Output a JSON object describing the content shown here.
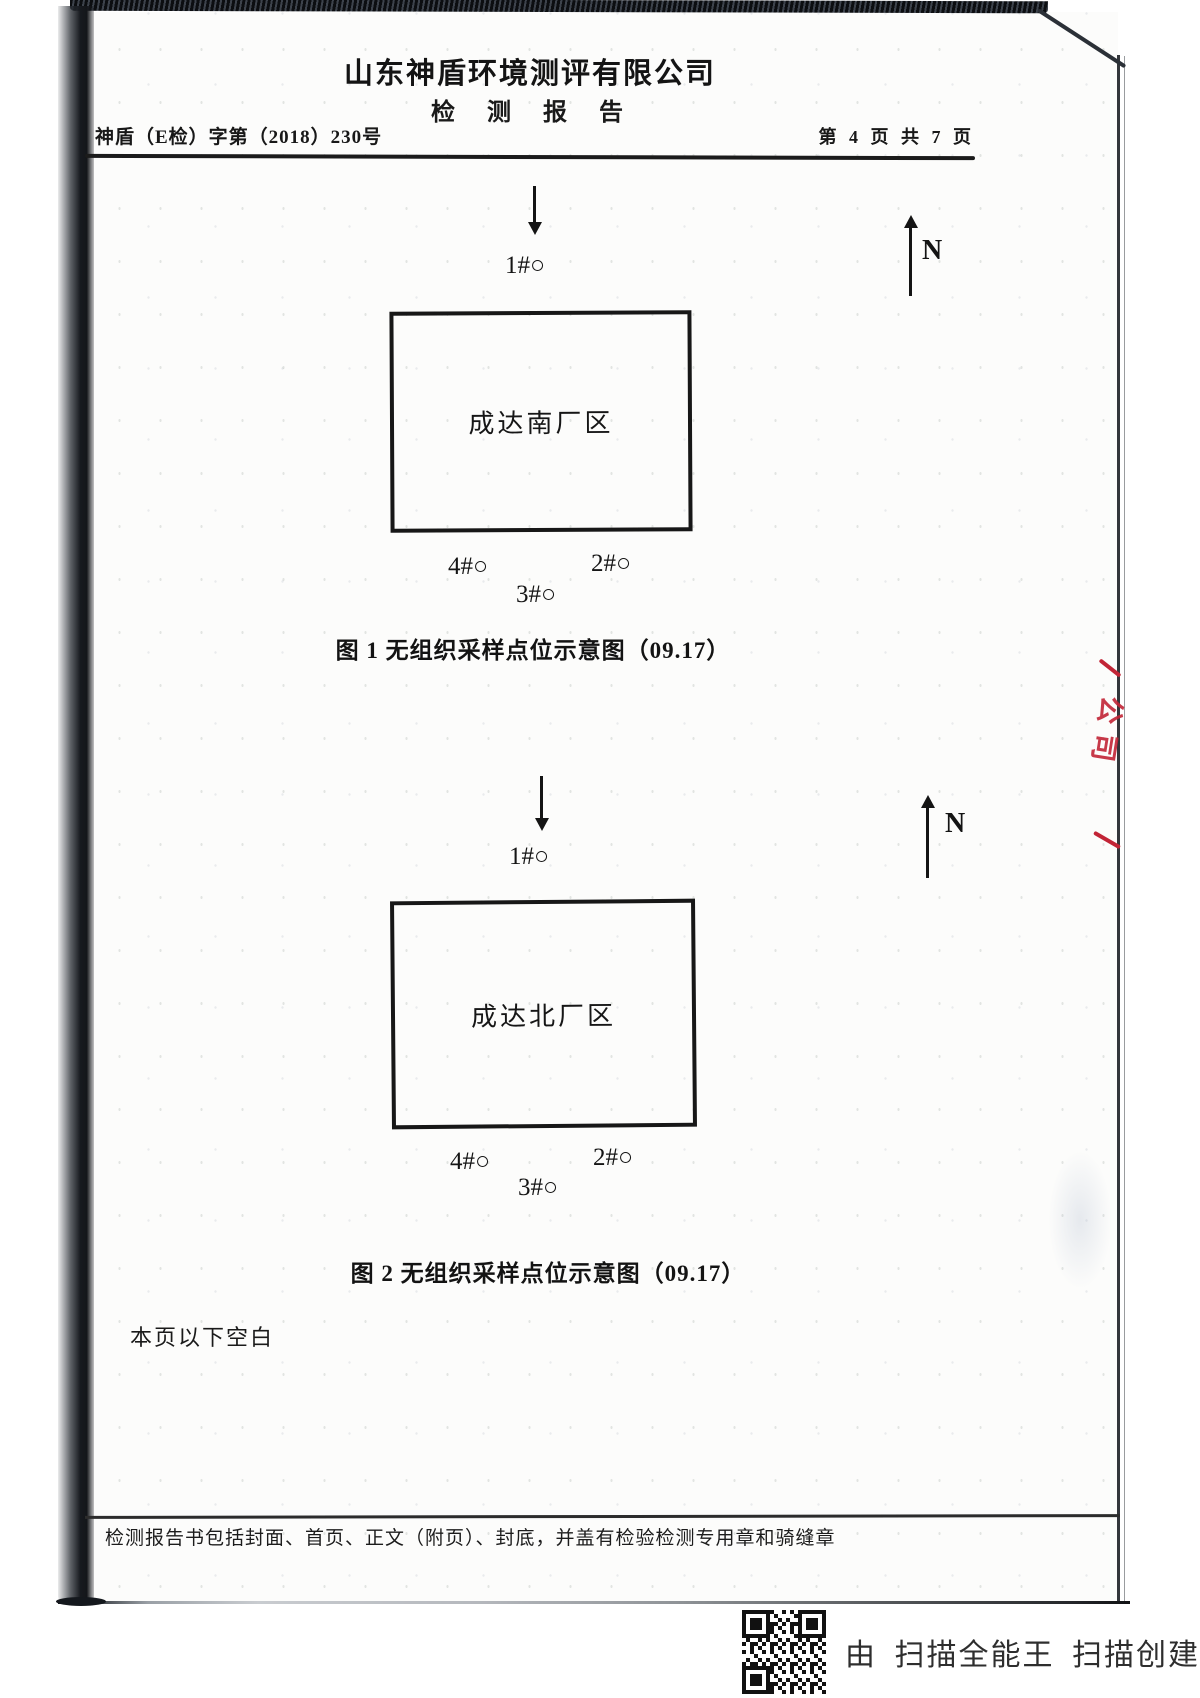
{
  "page": {
    "company": "山东神盾环境测评有限公司",
    "doc_title": "检 测 报 告",
    "report_no": "神盾（E检）字第（2018）230号",
    "page_info": "第 4 页 共 7 页",
    "blank_note": "本页以下空白",
    "footer_note": "检测报告书包括封面、首页、正文（附页）、封底，并盖有检验检测专用章和骑缝章"
  },
  "figures": [
    {
      "caption": "图 1 无组织采样点位示意图（09.17）",
      "site_label": "成达南厂区",
      "north_label": "N",
      "points": {
        "p1": "1#○",
        "p2": "2#○",
        "p3": "3#○",
        "p4": "4#○"
      }
    },
    {
      "caption": "图 2 无组织采样点位示意图（09.17）",
      "site_label": "成达北厂区",
      "north_label": "N",
      "points": {
        "p1": "1#○",
        "p2": "2#○",
        "p3": "3#○",
        "p4": "4#○"
      }
    }
  ],
  "seal": {
    "text": "公司",
    "color": "#c22436"
  },
  "scanner": {
    "credit": "由 扫描全能王 扫描创建"
  }
}
